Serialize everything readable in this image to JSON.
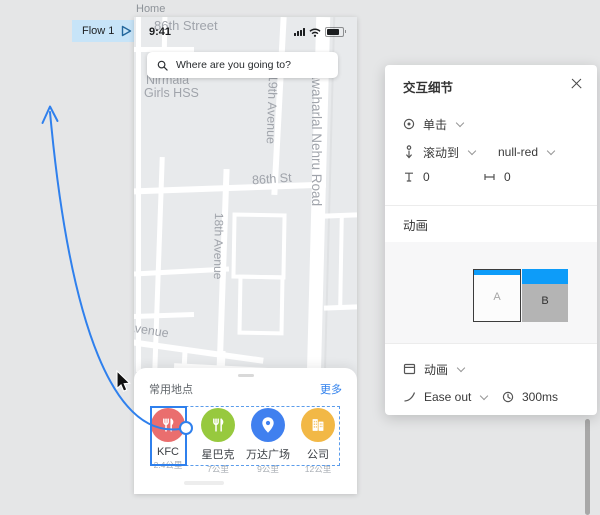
{
  "app": {
    "flow_button": "Flow 1",
    "frame_label": "Home"
  },
  "phone": {
    "statusbar": {
      "time": "9:41"
    },
    "search": {
      "query": "Where are you going to?"
    },
    "map": {
      "street_top": "86th Street",
      "poi_line1": "Nirmala",
      "poi_line2": "Girls HSS",
      "avenue_19": "19th Avenue",
      "nehru_road": "Jawaharlal Nehru Road",
      "street_86": "86th St",
      "avenue_18": "18th Avenue",
      "avenue_partial": "Avenue"
    },
    "sheet": {
      "title": "常用地点",
      "more_link": "更多",
      "places": [
        {
          "name": "KFC",
          "distance": "2.4公里",
          "color": "#ea6e6e",
          "icon": "cutlery-icon"
        },
        {
          "name": "星巴克",
          "distance": "7公里",
          "color": "#97c93e",
          "icon": "cutlery-icon"
        },
        {
          "name": "万达广场",
          "distance": "9公里",
          "color": "#4080ef",
          "icon": "map-pin-icon"
        },
        {
          "name": "公司",
          "distance": "12公里",
          "color": "#f2b846",
          "icon": "building-icon"
        }
      ]
    }
  },
  "panel": {
    "title": "交互细节",
    "trigger_label": "单击",
    "action_label": "滚动到",
    "action_target": "null-red",
    "offset_y": "0",
    "offset_x": "0",
    "animation_section_title": "动画",
    "preview": {
      "card_a_label": "A",
      "card_b_label": "B"
    },
    "animation_type_label": "动画",
    "easing_label": "Ease out",
    "duration_label": "300ms"
  },
  "colors": {
    "accent_blue": "#2f80ed",
    "prototype_blue": "#0d9cf9",
    "flow_chip_bg": "#c7e4f8",
    "more_link_blue": "#2f80ed",
    "kfc_red": "#ea6e6e",
    "starbucks_green": "#97c93e",
    "wanda_blue": "#4080ef",
    "company_yellow": "#f2b846",
    "canvas_bg": "#e5e6e7",
    "map_bg": "#e8eaec"
  }
}
